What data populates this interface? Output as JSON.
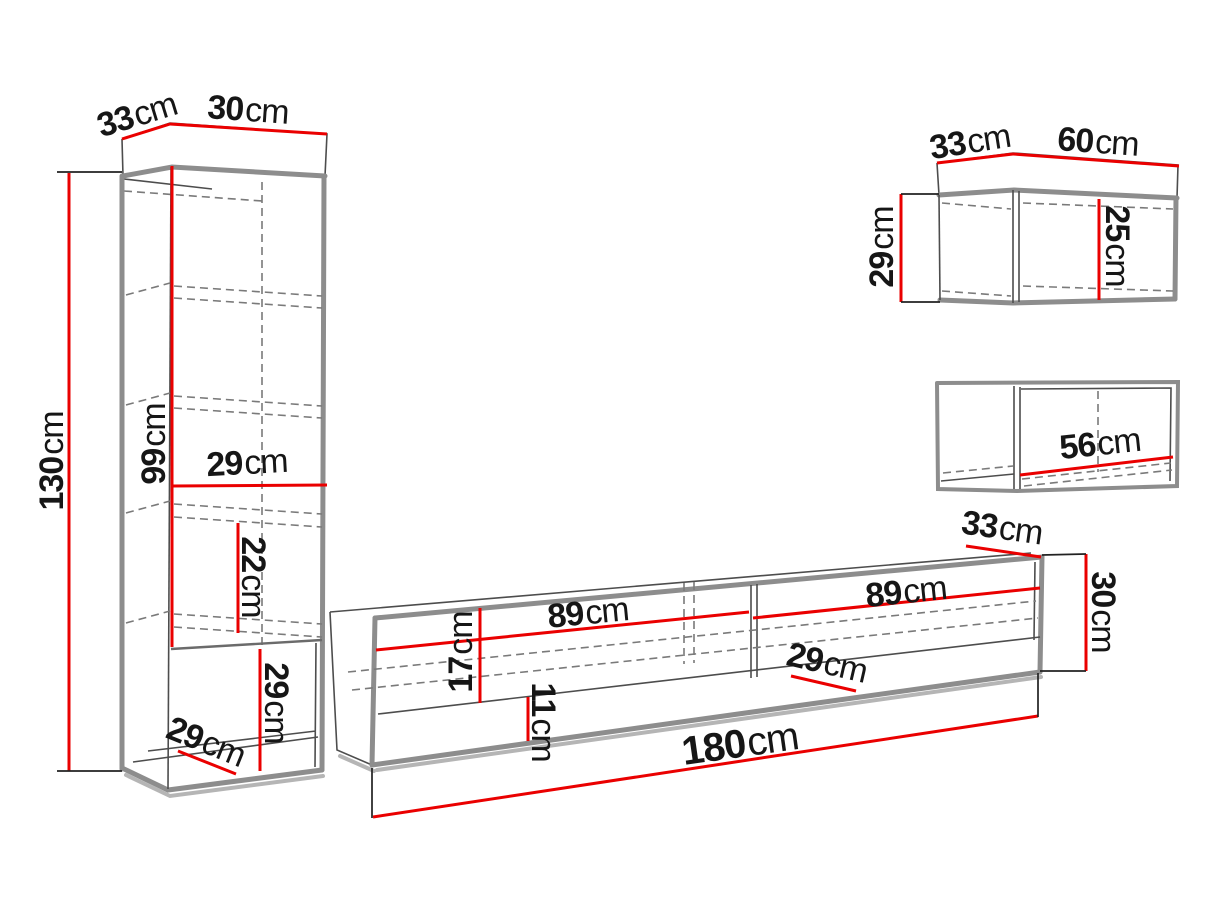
{
  "colors": {
    "background": "#ffffff",
    "dimension_line_red": "#ea0000",
    "text_black": "#161616",
    "edge_gray": "#8d8d8d",
    "line_dark": "#4d4d4d"
  },
  "diagram": {
    "unit": "cm",
    "tall_cabinet": {
      "depth": "33",
      "width": "30",
      "height": "130",
      "upper_section_height": "99",
      "interior_width": "29",
      "shelf_spacing": "22",
      "niche_height": "29",
      "niche_depth": "29"
    },
    "tv_stand": {
      "left_opening_width": "89",
      "right_opening_width": "89",
      "opening_height": "17",
      "base_height": "11",
      "interior_depth": "29",
      "top_depth": "33",
      "height": "30",
      "total_width": "180"
    },
    "wall_cabinet_top": {
      "depth": "33",
      "width": "60",
      "height": "29",
      "opening_height": "25"
    },
    "wall_cabinet_bottom": {
      "opening_width": "56"
    }
  }
}
